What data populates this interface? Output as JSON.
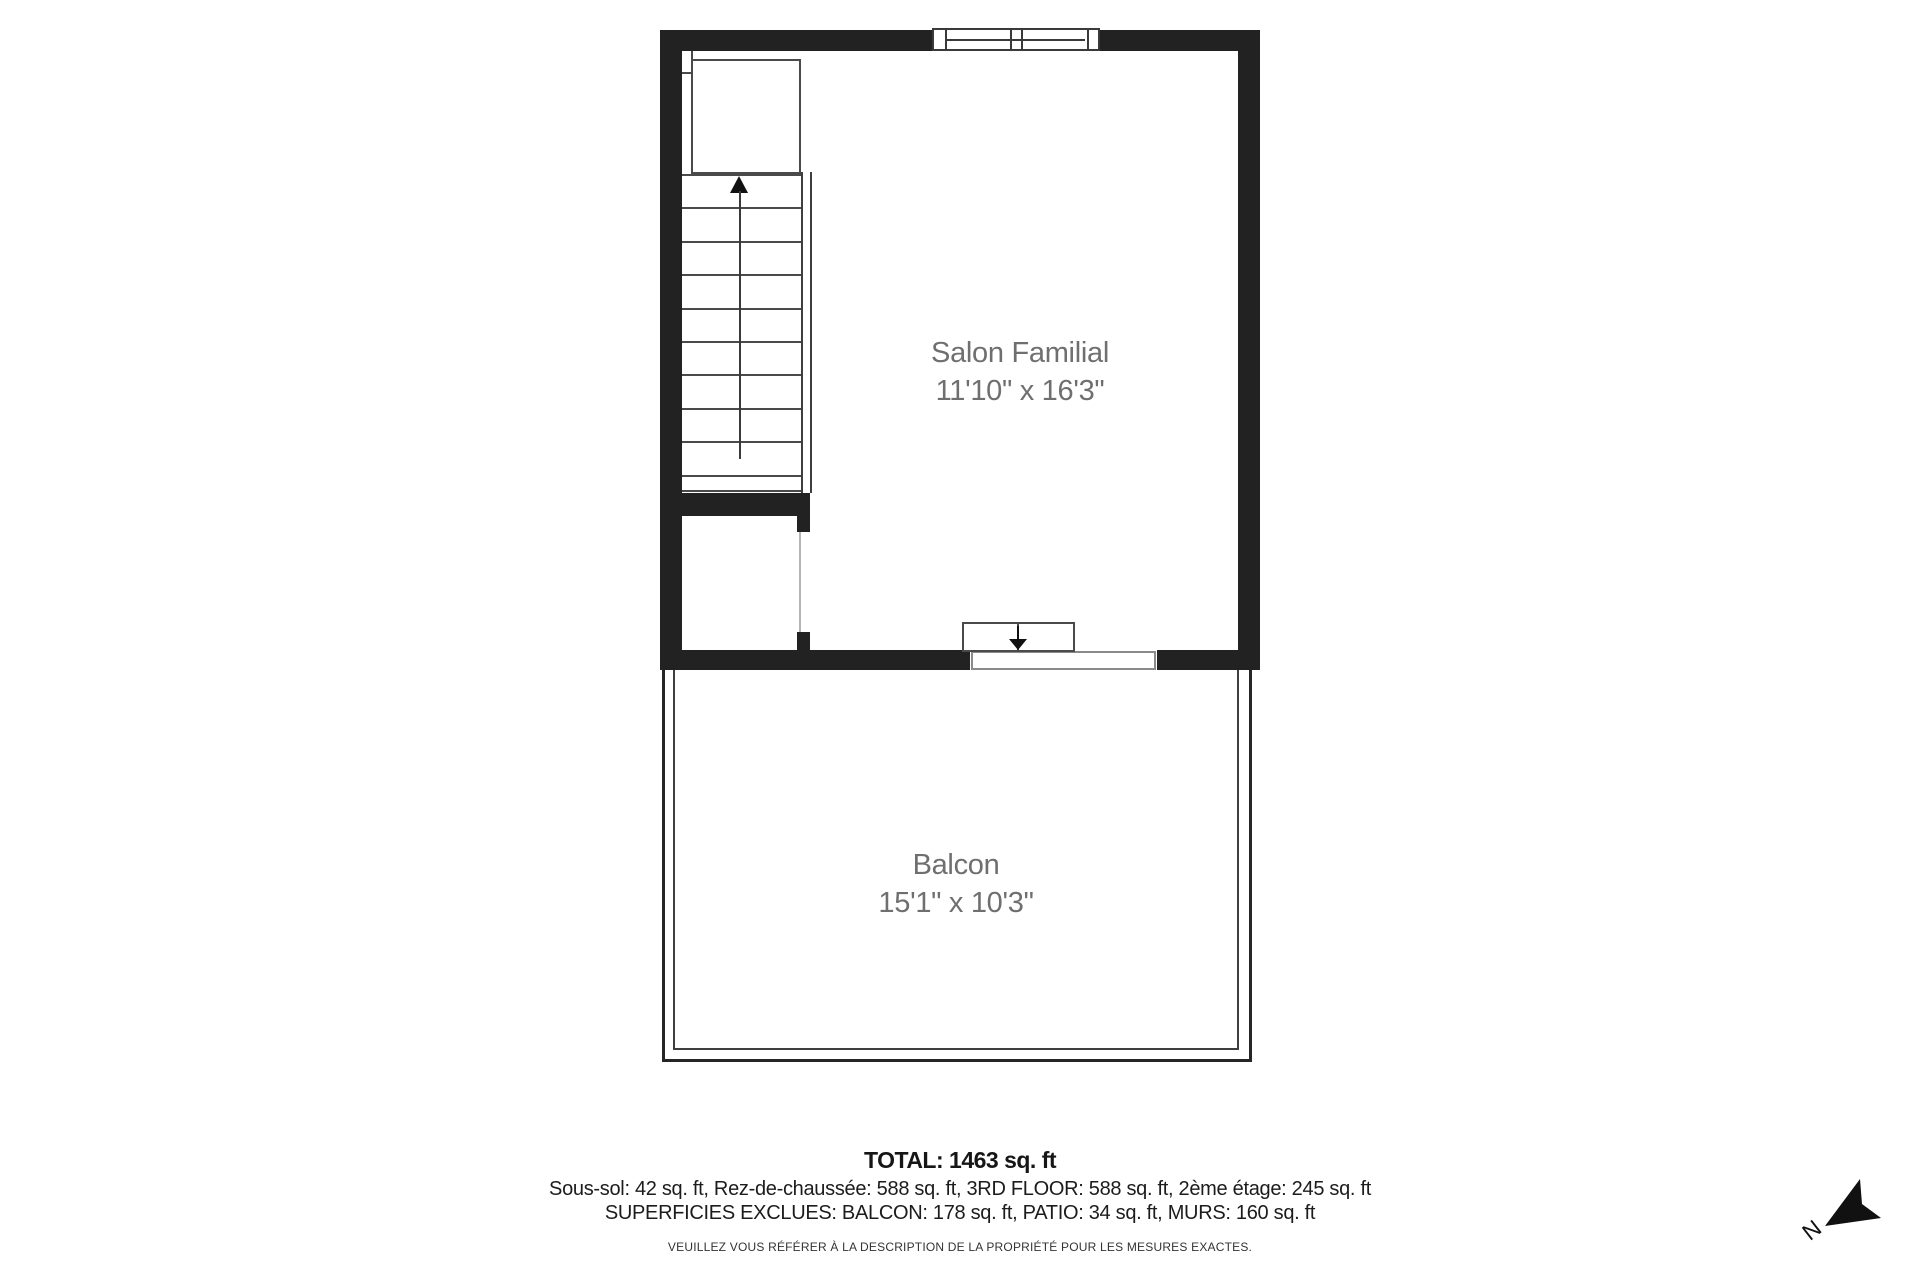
{
  "rooms": [
    {
      "name": "Salon Familial",
      "dimensions": "11'10\" x 16'3\""
    },
    {
      "name": "Balcon",
      "dimensions": "15'1\" x 10'3\""
    }
  ],
  "stairs": {
    "tread_rows": 10,
    "up_arrow_icon": "filled-triangle-up"
  },
  "door": {
    "down_arrow_icon": "filled-triangle-down"
  },
  "summary": {
    "total": "TOTAL: 1463 sq. ft",
    "floor_areas": "Sous-sol: 42 sq. ft, Rez-de-chaussée: 588 sq. ft, 3RD FLOOR: 588 sq. ft, 2ème étage: 245 sq. ft",
    "excluded_areas": "SUPERFICIES EXCLUES: BALCON: 178 sq. ft, PATIO: 34 sq. ft, MURS: 160 sq. ft",
    "disclaimer": "VEUILLEZ VOUS RÉFÉRER À LA DESCRIPTION DE LA PROPRIÉTÉ POUR LES MESURES EXACTES."
  },
  "compass": {
    "north_label": "N"
  },
  "colors": {
    "wall": "#222222",
    "thin_line": "#4a4a4a",
    "room_label": "#6f6f6f",
    "body_text": "#1c1c1c",
    "background": "#ffffff"
  }
}
